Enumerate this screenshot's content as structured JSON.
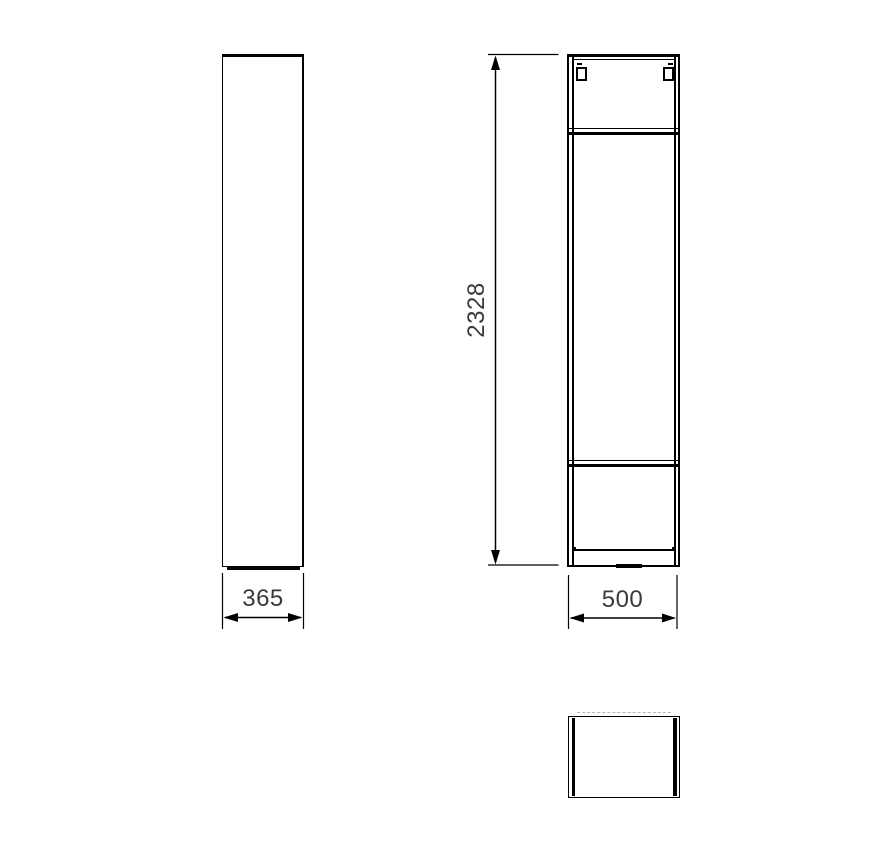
{
  "drawing": {
    "type": "furniture-technical-drawing-three-views",
    "dimensions": {
      "side_depth": {
        "label": "365"
      },
      "height": {
        "label": "2328"
      },
      "front_width": {
        "label": "500"
      }
    },
    "colors": {
      "line": "#000000",
      "label_text": "#3a3a3a",
      "background": "#ffffff"
    }
  }
}
